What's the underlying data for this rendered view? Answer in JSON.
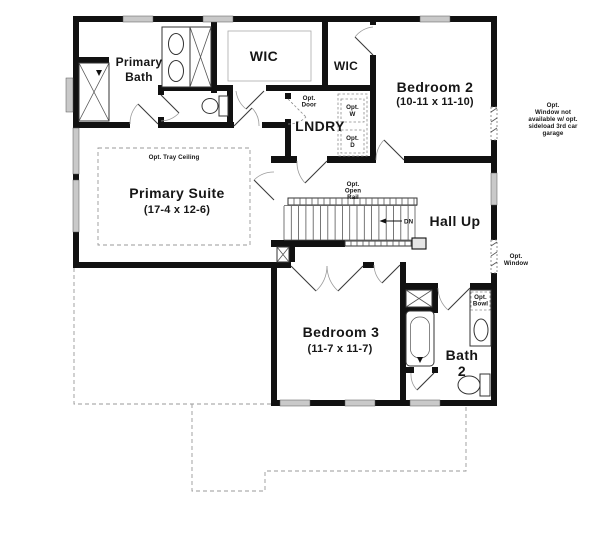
{
  "rooms": {
    "primary_bath": {
      "line1": "Primary",
      "line2": "Bath"
    },
    "wic_primary": {
      "label": "WIC"
    },
    "wic_bedroom2": {
      "label": "WIC"
    },
    "bedroom2": {
      "name": "Bedroom 2",
      "dims": "(10-11 x 11-10)"
    },
    "laundry": {
      "name": "LNDRY"
    },
    "primary_suite": {
      "name": "Primary Suite",
      "dims": "(17-4 x 12-6)"
    },
    "hall": {
      "name": "Hall Up"
    },
    "bedroom3": {
      "name": "Bedroom 3",
      "dims": "(11-7 x 11-7)"
    },
    "bath2": {
      "line1": "Bath",
      "line2": "2"
    }
  },
  "annotations": {
    "tray_ceiling": "Opt. Tray Ceiling",
    "open_rail": {
      "line1": "Opt.",
      "line2": "Open",
      "line3": "Rail"
    },
    "opt_door": {
      "line1": "Opt.",
      "line2": "Door"
    },
    "opt_washer": {
      "line1": "Opt.",
      "line2": "W"
    },
    "opt_dryer": {
      "line1": "Opt.",
      "line2": "D"
    },
    "window_note": {
      "line1": "Opt.",
      "line2": "Window not",
      "line3": "available w/ opt.",
      "line4": "sideload 3rd car",
      "line5": "garage"
    },
    "opt_window": {
      "line1": "Opt.",
      "line2": "Window"
    },
    "opt_bowl": {
      "line1": "Opt.",
      "line2": "Bowl"
    },
    "down_label": "DN"
  },
  "colors": {
    "wall": "#111111",
    "text": "#161616",
    "window_fill": "#c9c9c9",
    "dashed": "#999999",
    "background": "#ffffff"
  }
}
